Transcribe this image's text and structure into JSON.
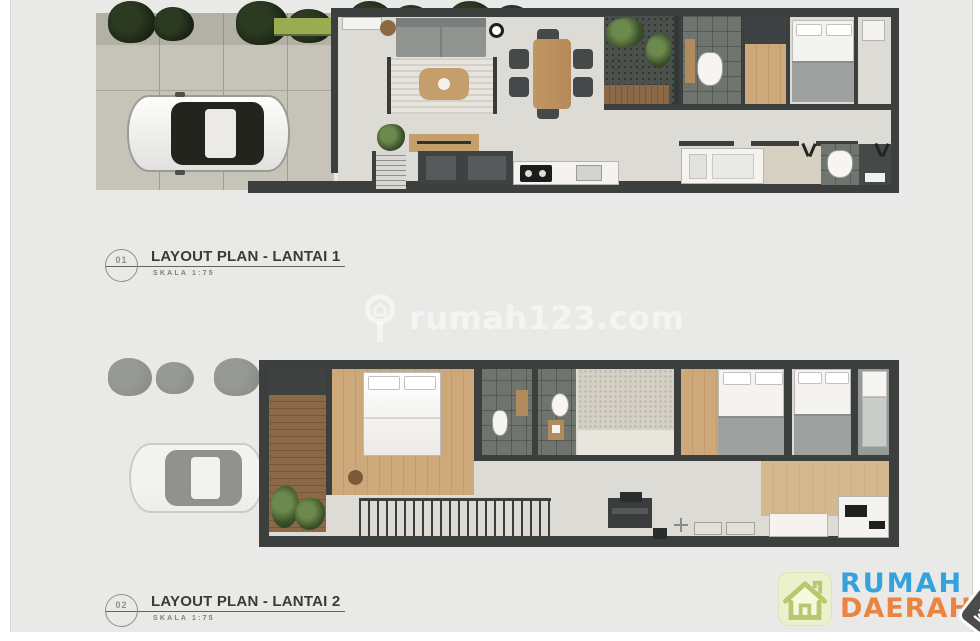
{
  "page": {
    "canvas_bg": "#ffffff",
    "photo_bg": "#e9e9e7"
  },
  "plans": [
    {
      "number": "01",
      "title": "LAYOUT PLAN - LANTAI 1",
      "scale": "SKALA 1:75"
    },
    {
      "number": "02",
      "title": "LAYOUT PLAN - LANTAI 2",
      "scale": "SKALA 1:75"
    }
  ],
  "watermark": {
    "text": "rumah123.com",
    "icon": "magnifier-house-icon"
  },
  "logo": {
    "word1": "RUMAH",
    "word2": "DAERAH",
    "tag": ".COM",
    "icon": "house-icon",
    "colors": {
      "word1": "#34a3db",
      "word2": "#eb8440",
      "tag_bg": "#4c4c4c",
      "tag_text": "#ffffff",
      "icon_bg": "#edf0cd",
      "icon_line": "#b6c96f"
    }
  },
  "floorplan_colors": {
    "wall": "#3b3f3e",
    "interior_floor": "#dcdbd6",
    "wood_floor": "#c9a273",
    "outdoor_paving": "#c6c3b8",
    "deck": "#8b6947",
    "dark_tile": "#6f746f",
    "gravel_court": "#4b504d",
    "foliage": "#22301c",
    "sofa": "#90938f",
    "bed_linen": "#f4f3f0",
    "blanket": "#9ea19f"
  },
  "floor1_features": [
    "street-trees",
    "carport-car",
    "planter-strip",
    "sofa",
    "rug",
    "coffee-table",
    "dining-table-6-chairs",
    "inner-courtyard-garden",
    "stairs",
    "kitchen-counter",
    "bathroom",
    "wardrobe",
    "bedroom",
    "laundry-counter",
    "service-bathroom"
  ],
  "floor2_features": [
    "ghost-carport-below",
    "balcony-deck-plants",
    "master-bedroom",
    "bathroom-1",
    "bathroom-2",
    "gravel-court",
    "bedroom-2",
    "bedroom-3",
    "single-bed-room",
    "void-railing",
    "study-desk",
    "family-area",
    "pantry-table"
  ]
}
